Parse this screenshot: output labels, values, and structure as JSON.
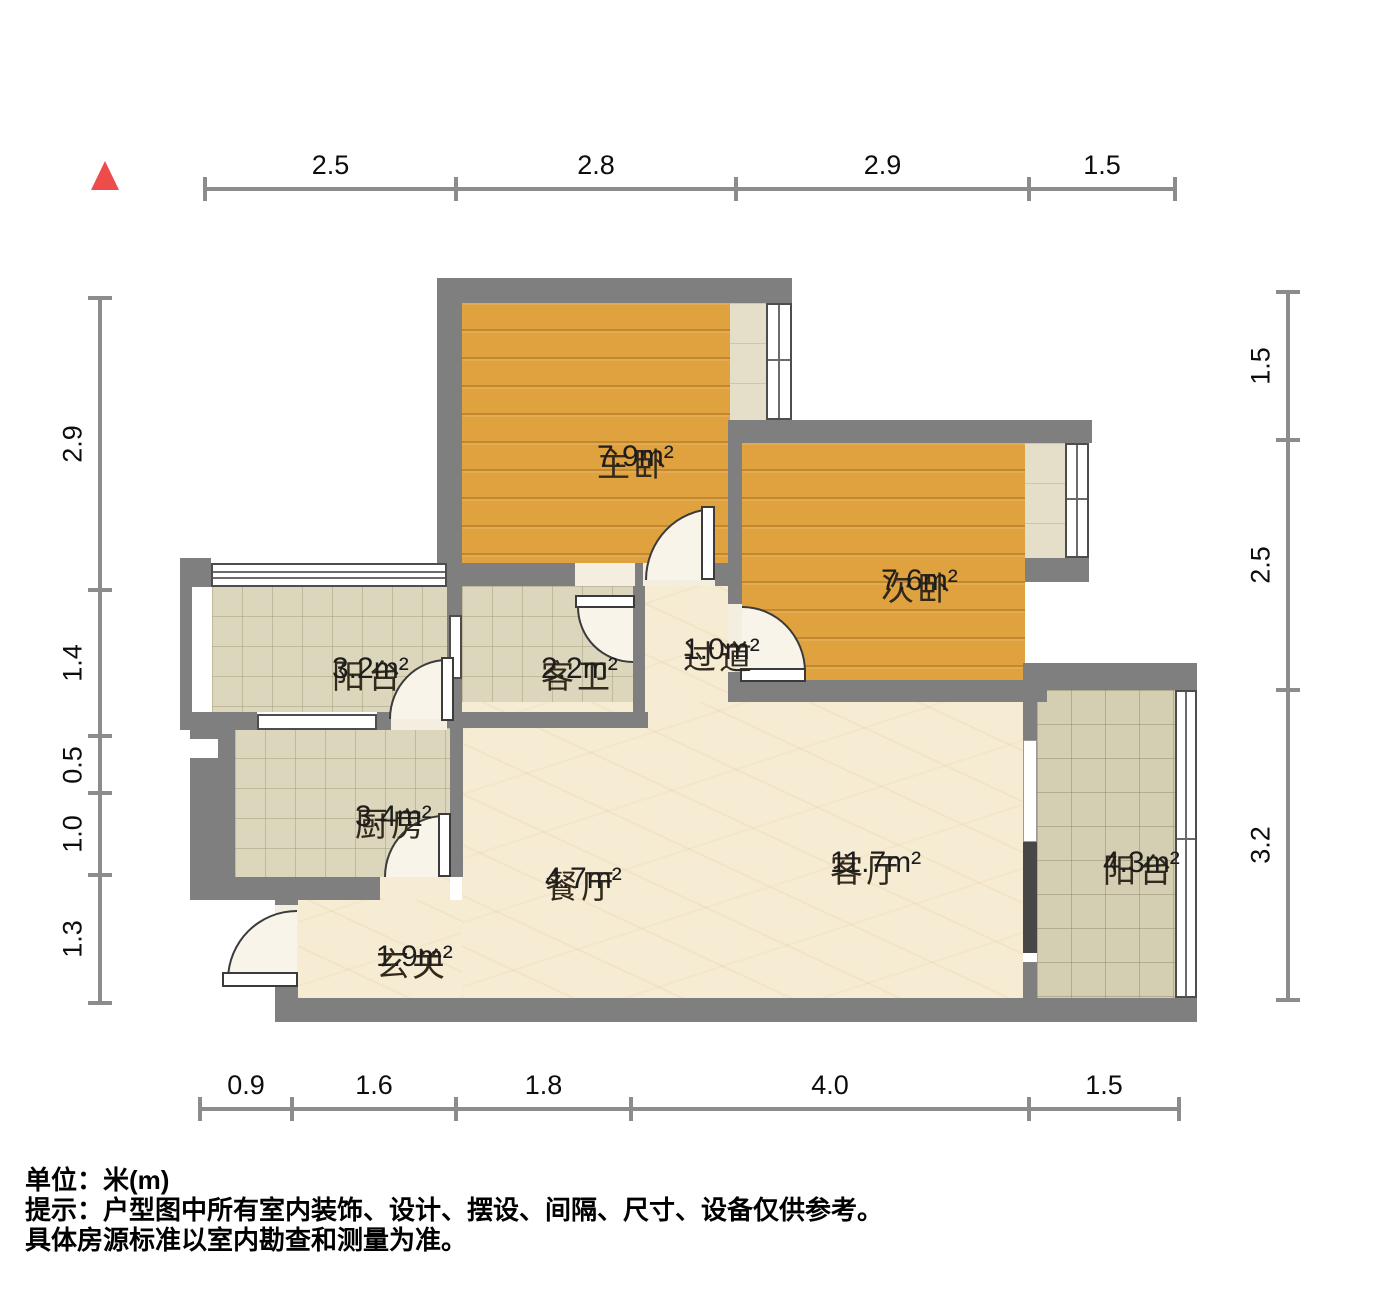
{
  "icons": {
    "north_marker": "red-triangle-north-icon"
  },
  "colors": {
    "wall": "#7f7f7f",
    "wall_dark": "#474747",
    "wood_floor": "#dfa23e",
    "tile_floor": "#dcd7bc",
    "marble_floor": "#f6ecd4",
    "north_red": "#ee4b4b"
  },
  "rooms": [
    {
      "id": "master-bedroom",
      "name": "主卧",
      "area": "7.9m²",
      "cx": 597,
      "cy": 438
    },
    {
      "id": "second-bedroom",
      "name": "次卧",
      "area": "7.6m²",
      "cx": 881,
      "cy": 562
    },
    {
      "id": "balcony-left",
      "name": "阳台",
      "area": "3.2m²",
      "cx": 332,
      "cy": 650
    },
    {
      "id": "guest-bathroom",
      "name": "客卫",
      "area": "2.2m²",
      "cx": 541,
      "cy": 650
    },
    {
      "id": "hallway",
      "name": "过道",
      "area": "1.0m²",
      "cx": 683,
      "cy": 631
    },
    {
      "id": "kitchen",
      "name": "厨房",
      "area": "3.4m²",
      "cx": 355,
      "cy": 798
    },
    {
      "id": "dining-room",
      "name": "餐厅",
      "area": "4.7m²",
      "cx": 545,
      "cy": 860
    },
    {
      "id": "living-room",
      "name": "客厅",
      "area": "11.7m²",
      "cx": 830,
      "cy": 844
    },
    {
      "id": "balcony-right",
      "name": "阳台",
      "area": "4.3m²",
      "cx": 1103,
      "cy": 844
    },
    {
      "id": "entryway",
      "name": "玄关",
      "area": "1.9m²",
      "cx": 376,
      "cy": 938
    }
  ],
  "dimensions": {
    "top": [
      "2.5",
      "2.8",
      "2.9",
      "1.5"
    ],
    "bottom": [
      "0.9",
      "1.6",
      "1.8",
      "4.0",
      "1.5"
    ],
    "left": [
      "2.9",
      "1.4",
      "0.5",
      "1.0",
      "1.3"
    ],
    "right": [
      "1.5",
      "2.5",
      "3.2"
    ]
  },
  "notes": {
    "unit": "单位：米(m)",
    "tip1": "提示：户型图中所有室内装饰、设计、摆设、间隔、尺寸、设备仅供参考。",
    "tip2": "具体房源标准以室内勘查和测量为准。"
  }
}
